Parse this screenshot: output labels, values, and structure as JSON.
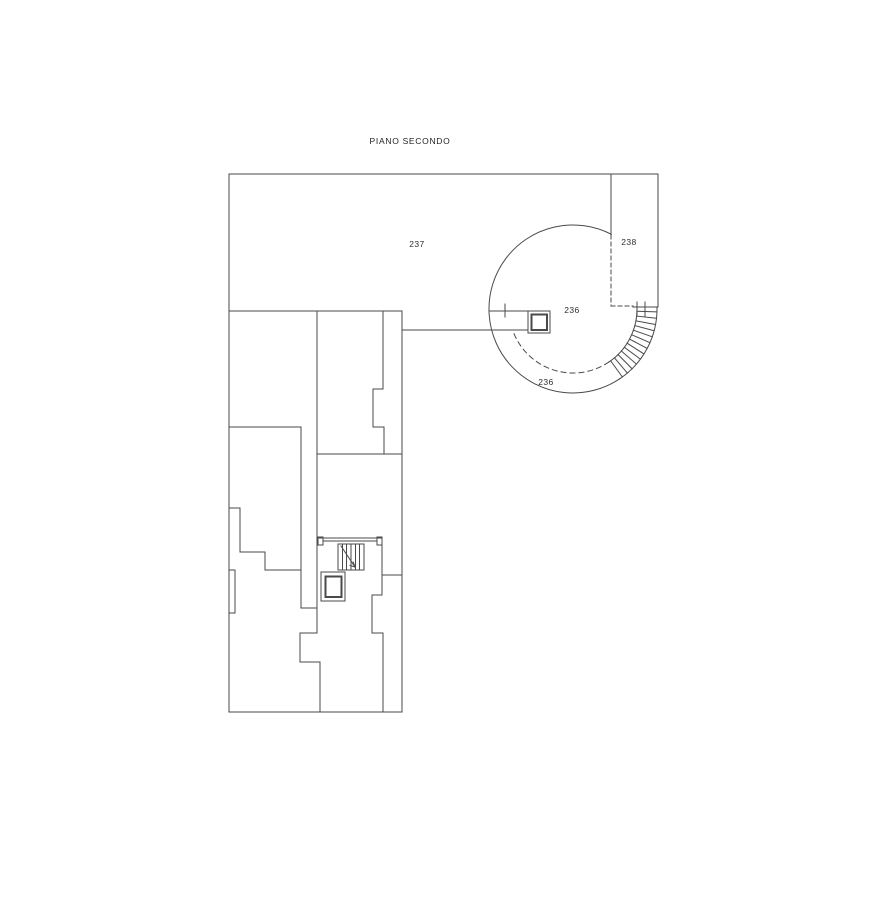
{
  "drawing": {
    "title": "PIANO SECONDO",
    "room_labels": {
      "r237": "237",
      "r238": "238",
      "r236_main": "236",
      "r236_gallery": "236"
    },
    "style": {
      "line_color": "#4a4a4a",
      "background_color": "#ffffff",
      "text_color": "#2e2e2e"
    }
  }
}
